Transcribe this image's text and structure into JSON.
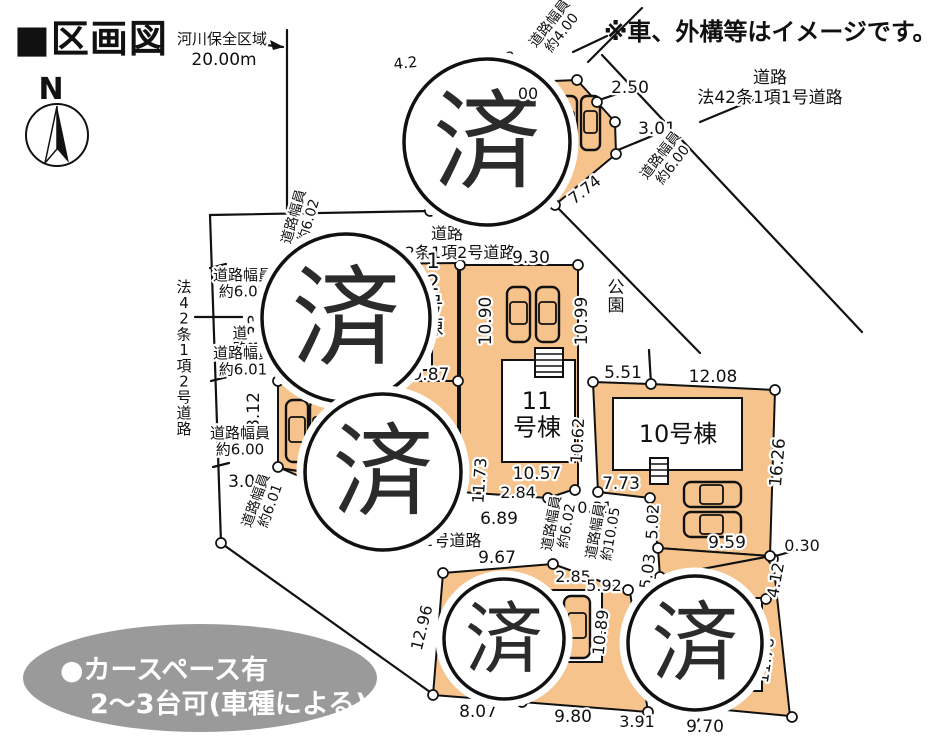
{
  "title": "■区画図",
  "disclaimer": "※車、外構等はイメージです。",
  "sold_mark": "済",
  "colors": {
    "lot_fill": "#f6c38c",
    "line": "#111111",
    "legend_bg": "#9a9a9a"
  },
  "map_labels": [
    {
      "n": "river-zone-label",
      "t": "河川保全区域",
      "x": 222,
      "y": 44,
      "s": 15
    },
    {
      "n": "river-zone-length",
      "t": "20.00m",
      "x": 224,
      "y": 65,
      "s": 17
    },
    {
      "n": "north-label",
      "t": "N",
      "x": 51,
      "y": 99,
      "s": 30,
      "bold": 1
    },
    {
      "n": "road-width-4-00",
      "t": "道路幅員",
      "t2": "約4.00",
      "x": 553,
      "y": 26,
      "s": 14,
      "rot": -52
    },
    {
      "n": "dim-2-50",
      "t": "2.50",
      "x": 630,
      "y": 93,
      "s": 17
    },
    {
      "n": "road1-label-1",
      "t": "道路",
      "x": 770,
      "y": 83,
      "s": 17
    },
    {
      "n": "road1-label-2",
      "t": "法42条1項1号道路",
      "x": 770,
      "y": 103,
      "s": 17
    },
    {
      "n": "dim-3-01",
      "t": "3.01",
      "x": 657,
      "y": 134,
      "s": 17
    },
    {
      "n": "road-width-6-00-diag",
      "t": "道路幅員",
      "t2": "約6.00",
      "x": 664,
      "y": 158,
      "s": 14,
      "rot": -52
    },
    {
      "n": "dim-7-74",
      "t": "7.74",
      "x": 588,
      "y": 194,
      "s": 16,
      "rot": -38
    },
    {
      "n": "dim-frag-4-2",
      "t": "4.2",
      "x": 406,
      "y": 68,
      "s": 15,
      "rot": -6
    },
    {
      "n": "dim-frag-43",
      "t": "43",
      "x": 506,
      "y": 63,
      "s": 15,
      "rot": -6
    },
    {
      "n": "dim-frag-00",
      "t": "00",
      "x": 528,
      "y": 99,
      "s": 16,
      "top": 1
    },
    {
      "n": "road2-label-1",
      "t": "道路",
      "x": 447,
      "y": 239,
      "s": 16
    },
    {
      "n": "road2-label-2",
      "t": "法42条1項2号道路",
      "x": 447,
      "y": 258,
      "s": 16
    },
    {
      "n": "dim-9-30",
      "t": "9.30",
      "x": 531,
      "y": 263,
      "s": 17
    },
    {
      "n": "road-width-6-02-diag",
      "t": "道路幅員",
      "t2": "約6.02",
      "x": 298,
      "y": 218,
      "s": 14,
      "rot": -74
    },
    {
      "n": "road-width-6-02",
      "t": "道路幅員",
      "t2": "約6.02",
      "x": 243,
      "y": 280,
      "s": 15
    },
    {
      "n": "road-label-vertical",
      "t": "道路",
      "x": 240,
      "y": 338,
      "s": 15,
      "v": 1
    },
    {
      "n": "road-law-vertical",
      "t": "法42条1項2号道路",
      "x": 184,
      "y": 292,
      "s": 15,
      "v": 1
    },
    {
      "n": "dim-8-33",
      "t": "8.33",
      "x": 260,
      "y": 333,
      "s": 17,
      "rot": -90
    },
    {
      "n": "road-width-6-01",
      "t": "道路幅員",
      "t2": "約6.01",
      "x": 243,
      "y": 358,
      "s": 15
    },
    {
      "n": "dim-8-12",
      "t": "8.12",
      "x": 259,
      "y": 411,
      "s": 17,
      "rot": -90
    },
    {
      "n": "road-width-6-00",
      "t": "道路幅員",
      "t2": "約6.00",
      "x": 240,
      "y": 438,
      "s": 15
    },
    {
      "n": "dim-3-00",
      "t": "3.00",
      "x": 247,
      "y": 487,
      "s": 17
    },
    {
      "n": "road-width-6-01-diag",
      "t": "道路幅員",
      "t2": "約6.01",
      "x": 260,
      "y": 502,
      "s": 14,
      "rot": -70
    },
    {
      "n": "dim-19-87",
      "t": "19.87",
      "x": 425,
      "y": 380,
      "s": 17
    },
    {
      "n": "lot-label-12",
      "t": "12号棟",
      "x": 433,
      "y": 268,
      "s": 21,
      "v": 1
    },
    {
      "n": "dim-10-90",
      "t": "10.90",
      "x": 491,
      "y": 321,
      "s": 17,
      "rot": -90
    },
    {
      "n": "dim-10-99",
      "t": "10.99",
      "x": 587,
      "y": 321,
      "s": 17,
      "rot": -90
    },
    {
      "n": "park-label",
      "t": "公園",
      "x": 616,
      "y": 293,
      "s": 17,
      "v": 1
    },
    {
      "n": "dim-5-51",
      "t": "5.51",
      "x": 623,
      "y": 378,
      "s": 17
    },
    {
      "n": "dim-12-08",
      "t": "12.08",
      "x": 713,
      "y": 382,
      "s": 17
    },
    {
      "n": "lot-label-10",
      "t": "10号棟",
      "x": 678,
      "y": 442,
      "s": 24
    },
    {
      "n": "dim-16-26",
      "t": "16.26",
      "x": 783,
      "y": 463,
      "s": 17,
      "rot": -85
    },
    {
      "n": "dim-7-73",
      "t": "7.73",
      "x": 621,
      "y": 489,
      "s": 17,
      "top": 1
    },
    {
      "n": "dim-0-31",
      "t": "0.31",
      "x": 595,
      "y": 513,
      "s": 16
    },
    {
      "n": "road-width-6-02-b",
      "t": "道路幅員",
      "t2": "約6.02",
      "x": 556,
      "y": 524,
      "s": 14,
      "rot": -80
    },
    {
      "n": "road-width-10-05",
      "t": "道路幅員",
      "t2": "約10.05",
      "x": 600,
      "y": 532,
      "s": 14,
      "rot": -80
    },
    {
      "n": "dim-10-62",
      "t": "10.62",
      "x": 583,
      "y": 441,
      "s": 16,
      "rot": -87
    },
    {
      "n": "dim-10-57",
      "t": "10.57",
      "x": 537,
      "y": 479,
      "s": 17,
      "top": 1
    },
    {
      "n": "dim-2-84",
      "t": "2.84",
      "x": 518,
      "y": 498,
      "s": 16
    },
    {
      "n": "dim-11-73",
      "t": "11.73",
      "x": 485,
      "y": 481,
      "s": 16,
      "rot": -86
    },
    {
      "n": "lot-label-11",
      "t": "11",
      "t2": "号棟",
      "x": 537,
      "y": 409,
      "s": 24
    },
    {
      "n": "dim-6-89",
      "t": "6.89",
      "x": 499,
      "y": 524,
      "s": 17
    },
    {
      "n": "road3-label",
      "t": "法42条1項2号道路",
      "x": 413,
      "y": 546,
      "s": 16
    },
    {
      "n": "dim-9-67",
      "t": "9.67",
      "x": 497,
      "y": 563,
      "s": 17
    },
    {
      "n": "dim-2-85",
      "t": "2.85",
      "x": 573,
      "y": 582,
      "s": 16
    },
    {
      "n": "dim-5-92",
      "t": "5.92",
      "x": 604,
      "y": 591,
      "s": 16
    },
    {
      "n": "dim-5-02",
      "t": "5.02",
      "x": 658,
      "y": 522,
      "s": 16,
      "rot": -87
    },
    {
      "n": "dim-5-03",
      "t": "5.03",
      "x": 653,
      "y": 572,
      "s": 16,
      "rot": -82
    },
    {
      "n": "dim-9-59",
      "t": "9.59",
      "x": 727,
      "y": 548,
      "s": 17,
      "top": 1
    },
    {
      "n": "dim-0-30",
      "t": "0.30",
      "x": 802,
      "y": 551,
      "s": 16
    },
    {
      "n": "dim-4-12",
      "t": "4.12",
      "x": 781,
      "y": 581,
      "s": 16,
      "rot": -80
    },
    {
      "n": "dim-11-78",
      "t": "11.78",
      "x": 771,
      "y": 661,
      "s": 16,
      "rot": -82
    },
    {
      "n": "dim-9-70",
      "t": "9.70",
      "x": 705,
      "y": 732,
      "s": 17
    },
    {
      "n": "dim-3-91",
      "t": "3.91",
      "x": 637,
      "y": 727,
      "s": 16
    },
    {
      "n": "dim-9-80",
      "t": "9.80",
      "x": 573,
      "y": 722,
      "s": 17
    },
    {
      "n": "dim-8-07",
      "t": "8.07",
      "x": 478,
      "y": 717,
      "s": 17
    },
    {
      "n": "dim-12-96",
      "t": "12.96",
      "x": 427,
      "y": 629,
      "s": 16,
      "rot": -76
    },
    {
      "n": "dim-10-89",
      "t": "10.89",
      "x": 606,
      "y": 633,
      "s": 16,
      "rot": -84
    },
    {
      "n": "legend-line1",
      "t": "●カースペース有",
      "x": 60,
      "y": 679,
      "s": 27,
      "bold": 1,
      "anchor": "start",
      "white": 1
    },
    {
      "n": "legend-line2",
      "t": "2～3台可(車種による)",
      "x": 90,
      "y": 713,
      "s": 27,
      "bold": 1,
      "anchor": "start",
      "white": 1
    }
  ],
  "sold_circles": [
    {
      "cx": 487,
      "cy": 142,
      "r": 83
    },
    {
      "cx": 346,
      "cy": 318,
      "r": 84
    },
    {
      "cx": 383,
      "cy": 472,
      "r": 78
    },
    {
      "cx": 504,
      "cy": 639,
      "r": 60
    },
    {
      "cx": 695,
      "cy": 643,
      "r": 67
    }
  ]
}
